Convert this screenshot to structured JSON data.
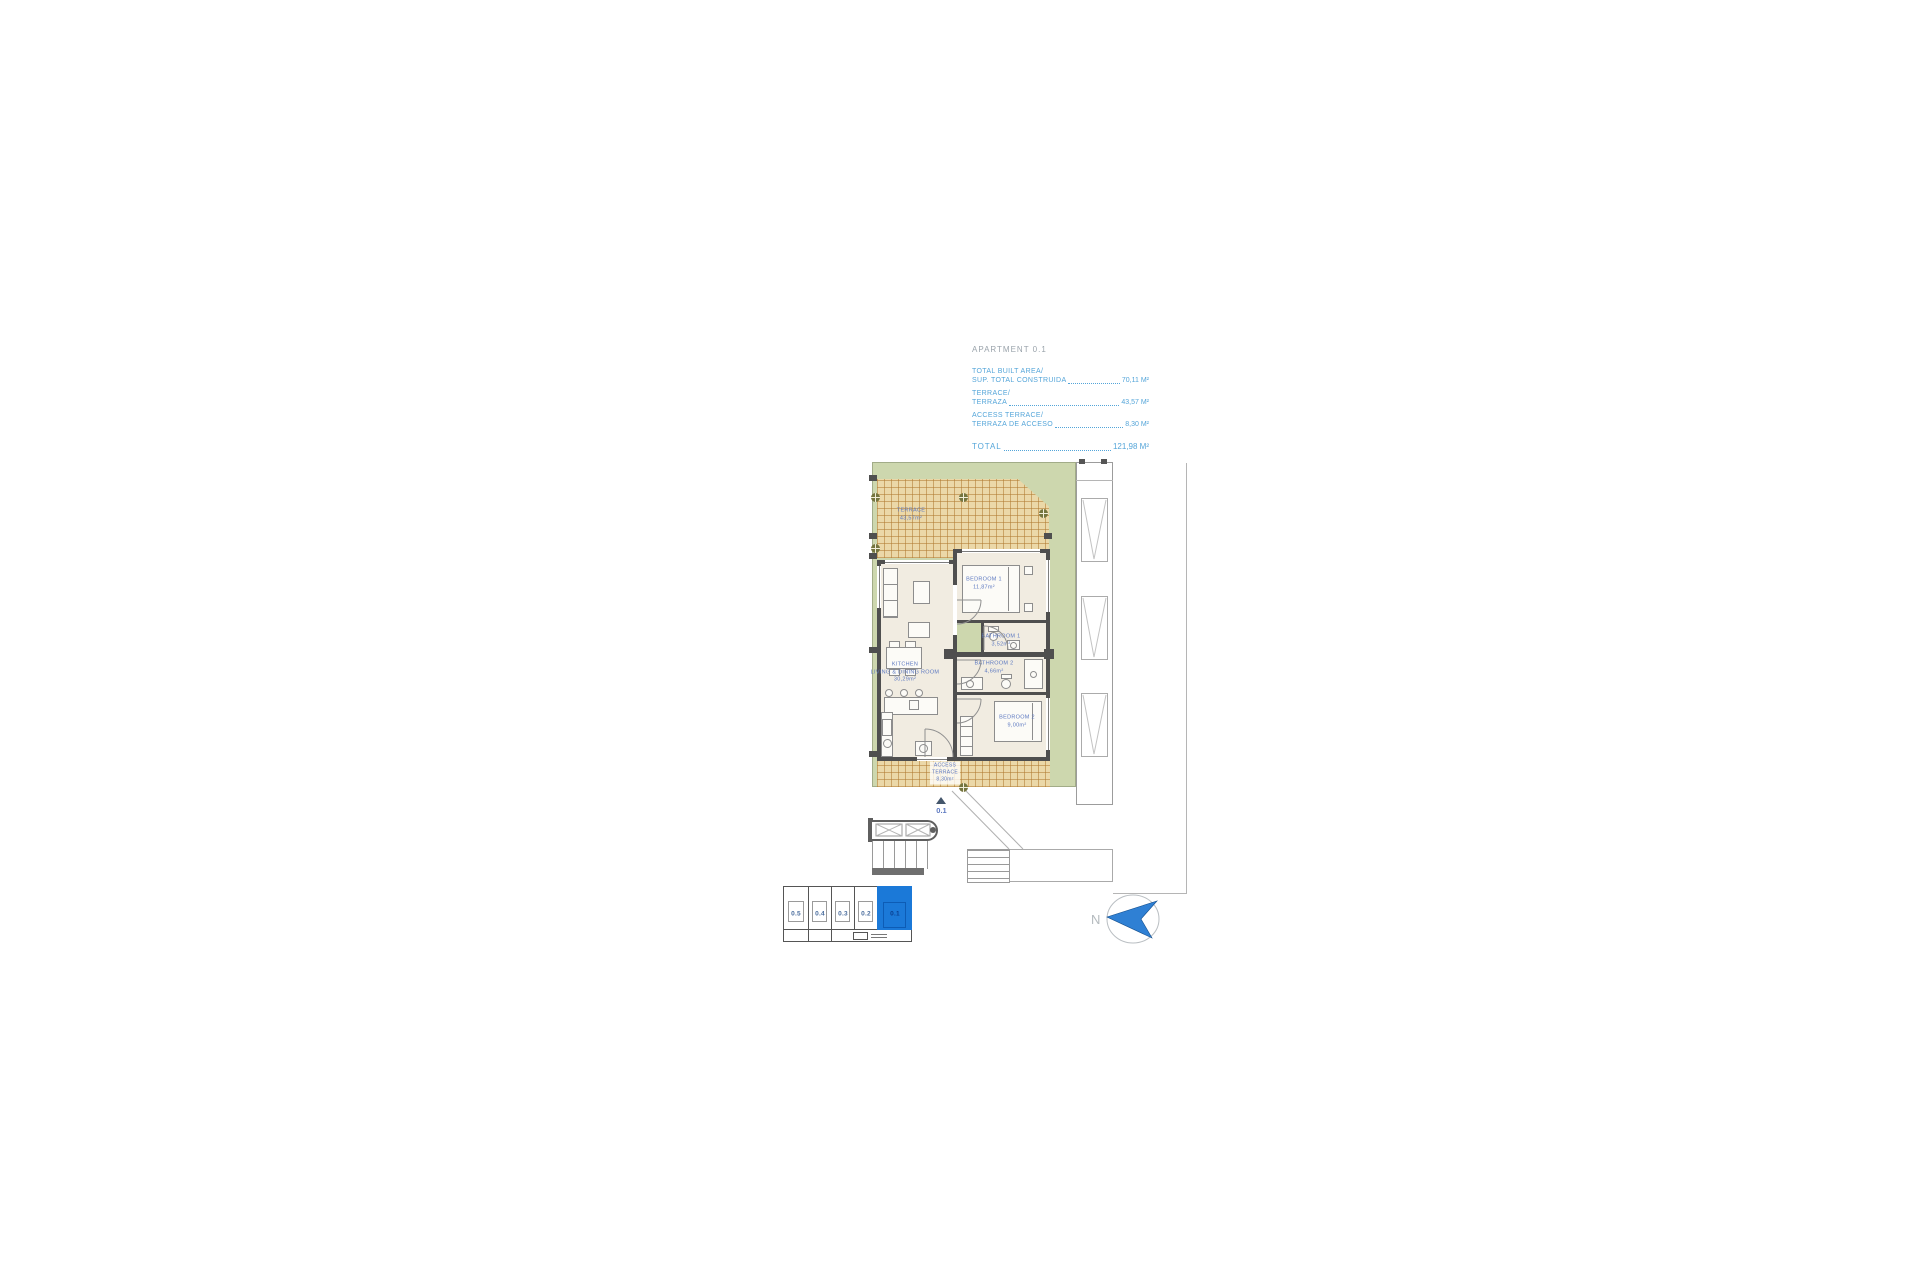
{
  "summary": {
    "title": "APARTMENT 0.1",
    "items": [
      {
        "label_line1": "TOTAL BUILT AREA/",
        "label_line2": "SUP. TOTAL CONSTRUIDA",
        "value": "70,11 M²"
      },
      {
        "label_line1": "TERRACE/",
        "label_line2": "TERRAZA",
        "value": "43,57 M²"
      },
      {
        "label_line1": "ACCESS TERRACE/",
        "label_line2": "TERRAZA DE ACCESO",
        "value": "8,30 M²"
      }
    ],
    "total_label": "TOTAL",
    "total_value": "121,98 M²"
  },
  "plan": {
    "rooms": {
      "terrace": {
        "name": "TERRACE",
        "area": "43,57m²"
      },
      "kitchen_living": {
        "name_line1": "KITCHEN",
        "name_line2": "LIVING & DINING ROOM",
        "area": "30,29m²"
      },
      "bedroom1": {
        "name": "BEDROOM 1",
        "area": "11,87m²"
      },
      "bathroom1": {
        "name": "BATHROOM 1",
        "area": "3,52m²"
      },
      "bathroom2": {
        "name": "BATHROOM 2",
        "area": "4,66m²"
      },
      "bedroom2": {
        "name": "BEDROOM 2",
        "area": "9,00m²"
      },
      "access_terrace": {
        "name_line1": "ACCESS",
        "name_line2": "TERRACE",
        "area": "8,30m²"
      }
    },
    "unit_marker": "0.1"
  },
  "keyplan": {
    "units": [
      {
        "label": "0.5",
        "highlighted": false
      },
      {
        "label": "0.4",
        "highlighted": false
      },
      {
        "label": "0.3",
        "highlighted": false
      },
      {
        "label": "0.2",
        "highlighted": false
      },
      {
        "label": "0.1",
        "highlighted": true
      }
    ]
  },
  "compass": {
    "label": "N"
  },
  "colors": {
    "accent-blue": "#54a5d9",
    "title-gray": "#9aa3ab",
    "label-blue": "#5d79c1",
    "keyplan-blue": "#1b79d8",
    "keyplan-blue-dark": "#0d5cb5",
    "garden-green": "#cdd7ae",
    "terrace-tan": "#ebd8a8",
    "floor": "#f1ece1",
    "wall": "#4f4f4f",
    "compass-blue": "#2f80d4"
  }
}
